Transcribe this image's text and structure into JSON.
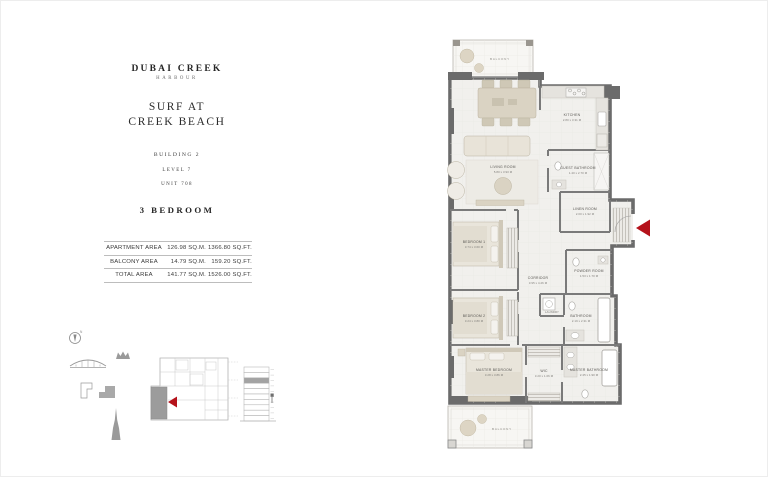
{
  "colors": {
    "accent": "#b5121b",
    "wall": "#6b6b6b"
  },
  "header": {
    "brand_line1": "DUBAI CREEK",
    "brand_line2": "HARBOUR",
    "project_line1": "SURF AT",
    "project_line2": "CREEK BEACH",
    "building": "BUILDING 2",
    "level": "LEVEL 7",
    "unit": "UNIT 708",
    "unit_type": "3 BEDROOM"
  },
  "area_table": {
    "rows": [
      {
        "label": "APARTMENT AREA",
        "sqm": "126.98 SQ.M.",
        "sqft": "1366.80 SQ.FT."
      },
      {
        "label": "BALCONY AREA",
        "sqm": "14.79 SQ.M.",
        "sqft": "159.20 SQ.FT."
      },
      {
        "label": "TOTAL AREA",
        "sqm": "141.77 SQ.M.",
        "sqft": "1526.00 SQ.FT."
      }
    ]
  },
  "floor_plan": {
    "compass_n": "N",
    "rooms": {
      "balcony_top": {
        "name": "BALCONY"
      },
      "kitchen": {
        "name": "KITCHEN",
        "dims": "2.80 x 3.31 M"
      },
      "living_room": {
        "name": "LIVING ROOM",
        "dims": "5.80 x 3.93 M"
      },
      "guest_bathroom": {
        "name": "GUEST BATHROOM",
        "dims": "1.40 x 2.70 M"
      },
      "linen_room": {
        "name": "LINEN ROOM",
        "dims": "2.00 x 1.92 M"
      },
      "bedroom_1": {
        "name": "BEDROOM 1",
        "dims": "3.74 x 3.60 M"
      },
      "corridor": {
        "name": "CORRIDOR",
        "dims": "3.95 x 4.26 M"
      },
      "powder_room": {
        "name": "POWDER ROOM",
        "dims": "1.53 x 1.70 M"
      },
      "laundry": {
        "name": "LAUNDRY",
        "dims": "0.87 x 2.00 M"
      },
      "bedroom_2": {
        "name": "BEDROOM 2",
        "dims": "3.24 x 3.80 M"
      },
      "bathroom": {
        "name": "BATHROOM",
        "dims": "2.19 x 2.31 M"
      },
      "master_bedroom": {
        "name": "MASTER BEDROOM",
        "dims": "3.28 x 3.86 M"
      },
      "wic": {
        "name": "WIC",
        "dims": "3.20 x 1.06 M"
      },
      "master_bathroom": {
        "name": "MASTER BATHROOM",
        "dims": "2.45 x 1.90 M"
      },
      "balcony_bottom": {
        "name": "BALCONY"
      }
    }
  }
}
